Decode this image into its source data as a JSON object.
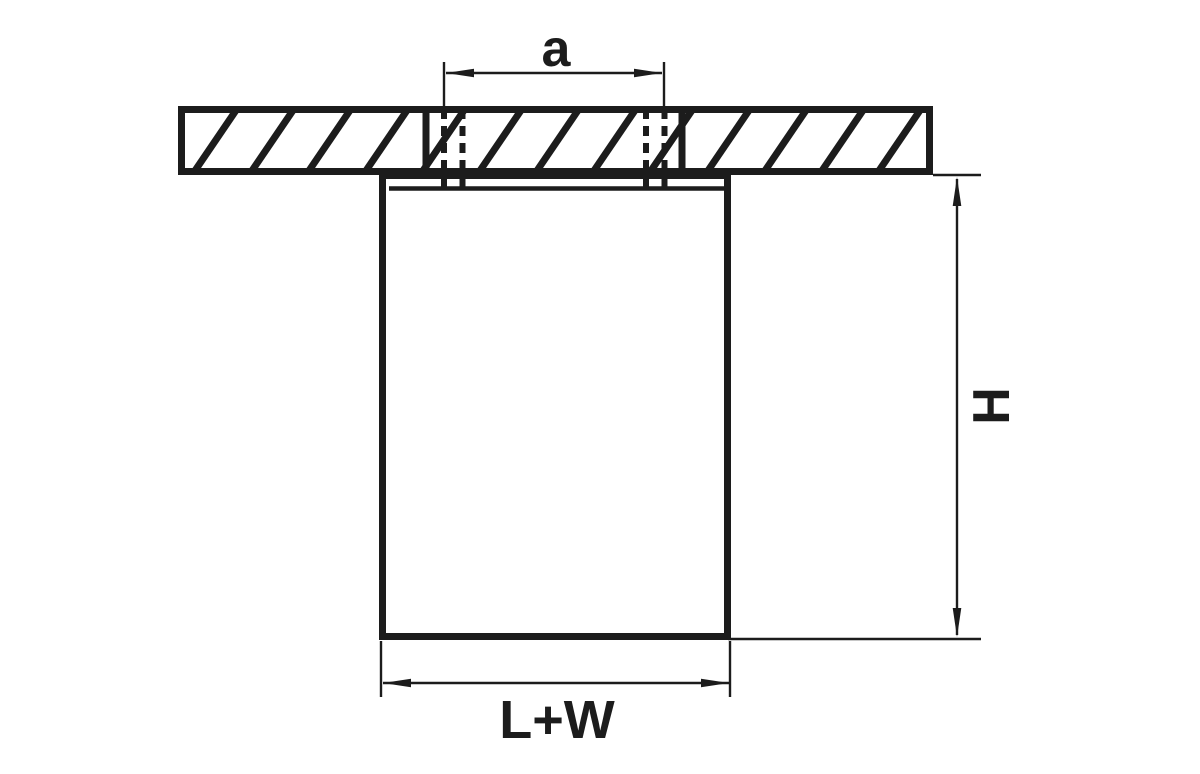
{
  "page": {
    "background": "#ffffff"
  },
  "drawing": {
    "kind": "dimension-drawing",
    "subject": "surface-mounted-ceiling-fixture-cross-section",
    "ink_color": "#1c1c1c",
    "labels": {
      "hole_spacing": "a",
      "height": "H",
      "width": "L+W"
    }
  }
}
